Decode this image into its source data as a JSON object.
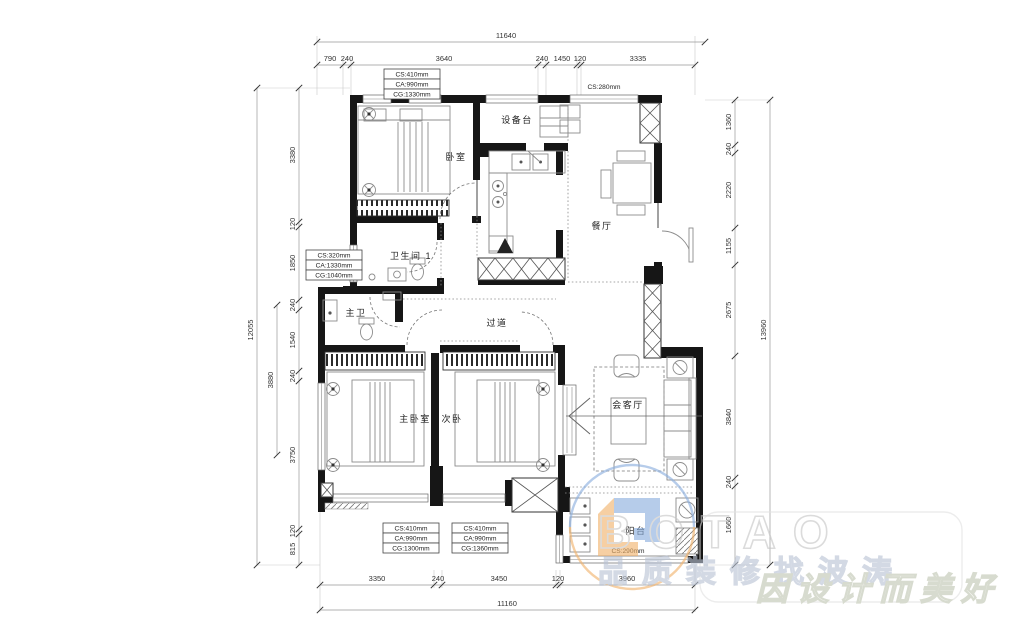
{
  "rooms": {
    "bedroom": "卧室",
    "equipment": "设备台",
    "dining": "餐厅",
    "bath1": "卫生间 1",
    "master_bath": "主卫",
    "corridor": "过道",
    "master_bedroom": "主卧室",
    "second_bedroom": "次卧",
    "living": "会客厅",
    "balcony": "阳台"
  },
  "window_specs": {
    "box1": {
      "l1": "CS:410mm",
      "l2": "CA:990mm",
      "l3": "CG:1330mm"
    },
    "box2": {
      "l1": "CS:320mm",
      "l2": "CA:1330mm",
      "l3": "CG:1040mm"
    },
    "box3": {
      "l1": "CS:410mm",
      "l2": "CA:990mm",
      "l3": "CG:1300mm"
    },
    "box4": {
      "l1": "CS:410mm",
      "l2": "CA:990mm",
      "l3": "CG:1360mm"
    },
    "top_right": "CS:280mm",
    "balcony": "CS:290mm"
  },
  "dimensions": {
    "top_total": "11640",
    "top": [
      "790",
      "240",
      "3640",
      "240",
      "1450",
      "120",
      "3335"
    ],
    "left_total": "12055",
    "left_partial": "3880",
    "left": [
      "3380",
      "120",
      "1850",
      "240",
      "1540",
      "240",
      "3750",
      "120",
      "815"
    ],
    "right_total": "13960",
    "right": [
      "1360",
      "240",
      "2220",
      "1155",
      "2675",
      "3840",
      "240",
      "1660"
    ],
    "bottom": [
      "3350",
      "240",
      "3450",
      "120",
      "3960"
    ],
    "bottom_total": "11160"
  },
  "watermark": {
    "brand": "BOTAO",
    "tagline1": "品质装修找波涛",
    "tagline2": "因设计而美好"
  },
  "colors": {
    "wall": "#161616",
    "dimension_line": "#999999",
    "accent_orange": "#f2b36b",
    "accent_blue": "#8aaede"
  }
}
